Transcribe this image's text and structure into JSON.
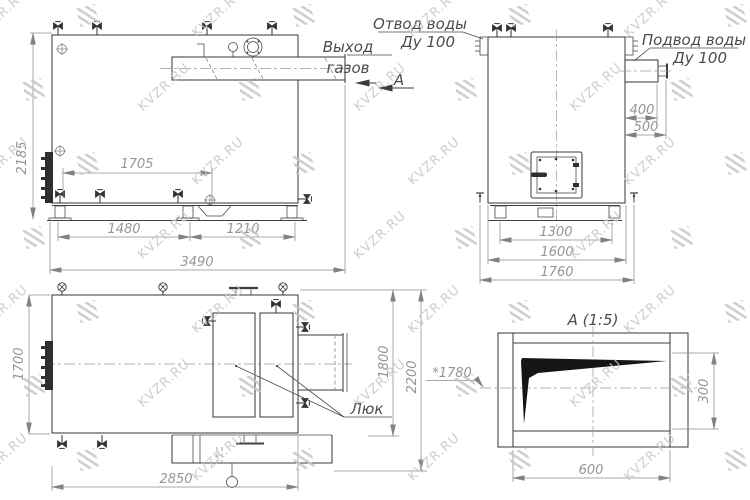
{
  "watermark": {
    "text": "KVZR.RU"
  },
  "labels": {
    "water_outlet": [
      "Отвод воды",
      "Ду 100"
    ],
    "water_supply": [
      "Подвод воды",
      "Ду 100"
    ],
    "gas_exit": [
      "Выход",
      "газов"
    ],
    "section_letter": "А",
    "hatch_label": "Люк",
    "detail_title": "А (1:5)"
  },
  "dims": {
    "side": {
      "height": "2185",
      "spacing": "1705",
      "front_base": "1480",
      "rear_base": "1210",
      "total_length": "3490"
    },
    "back": {
      "nozzle_400": "400",
      "nozzle_500": "500",
      "base_1300": "1300",
      "width_1600": "1600",
      "overall_1760": "1760"
    },
    "plan": {
      "width_1700": "1700",
      "width_1800": "1800",
      "overall_2200": "2200",
      "length_2850": "2850",
      "flue_height": "*1780"
    },
    "detail": {
      "opening_width": "600",
      "opening_height": "300"
    }
  }
}
